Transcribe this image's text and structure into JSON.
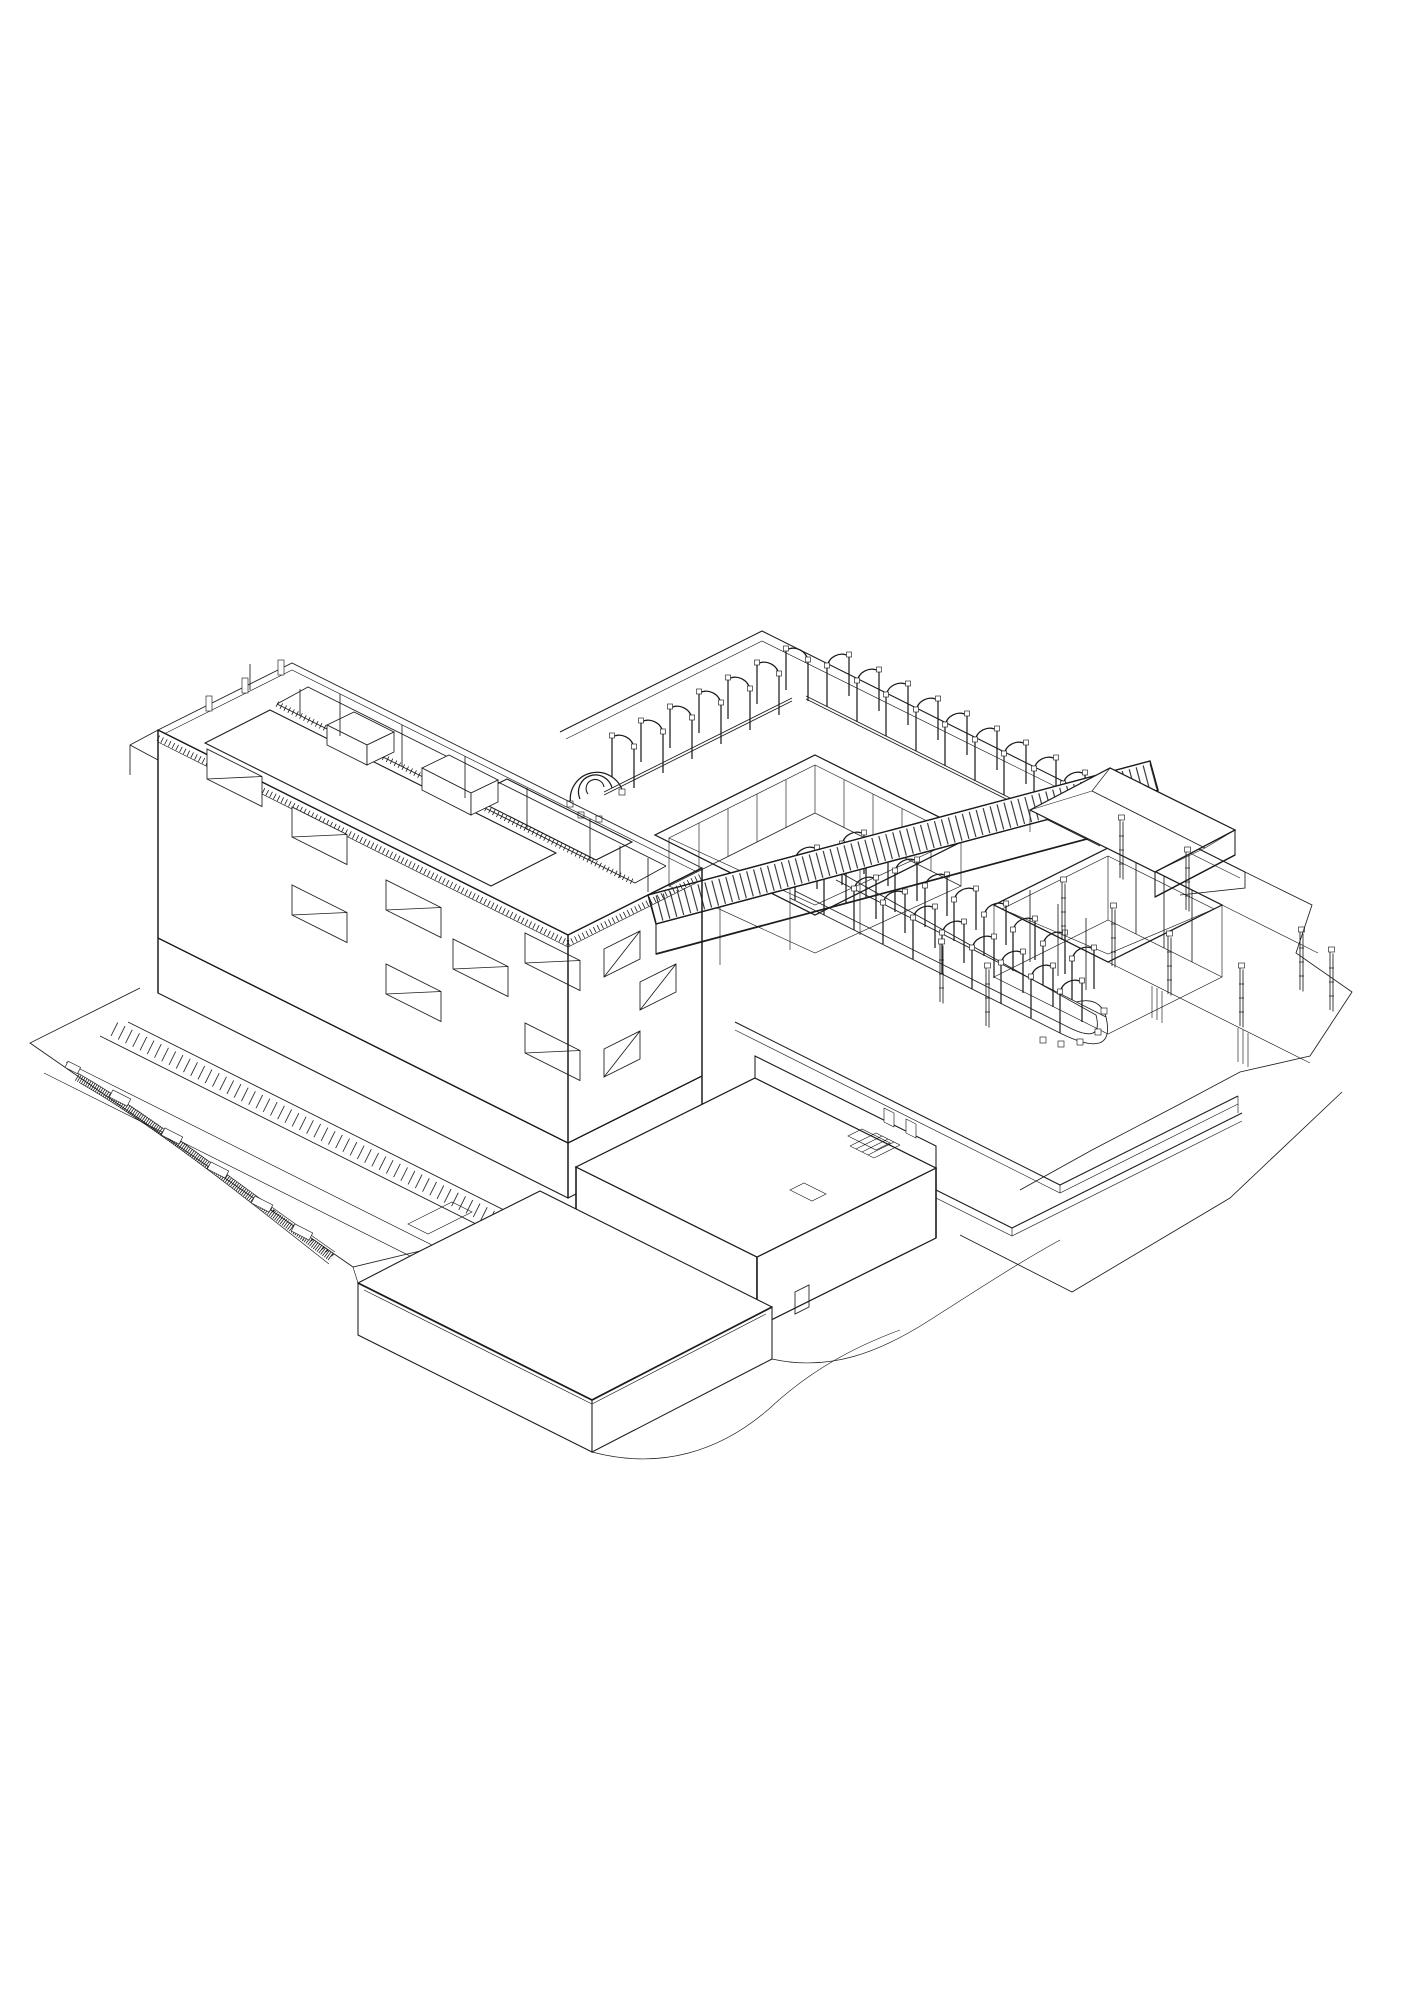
{
  "canvas": {
    "width": 1414,
    "height": 2000,
    "paper_color": "#ffffff",
    "ink_color": "#1c1c1c"
  },
  "scene": {
    "labels": {
      "drawing": "Black and white axonometric architectural line drawing of a building complex",
      "tower": "Multi-storey slab tower with gridded window facade",
      "tower_roof": "Tower roof with sawtooth photovoltaic panel arrays, parapets, bulkhead boxes and slender poles",
      "facade_sw": "South-west facade grid with recessed balconies",
      "facade_se": "South-east facade grid with recessed balconies",
      "podium_plane": "Large flat podium roof plane",
      "courtyard_main": "Central courtyard void with interior columns",
      "courtyard_east": "Eastern sunken courtyard with tall columns",
      "skybridge": "Diagonal rooftop walkway bridge with slatted deck and glazed rail",
      "pergola_upper": "Upper row of arched pergola hoops ending in a spiral curl",
      "pergola_lower": "Lower arched pergola promenade looping in a hairpin",
      "pavilion": "Small roof pavilion with folded plate roof and clerestory glazing",
      "terraces": "Stepped south-east terraces with slender service posts",
      "site_boundary": "Irregular site boundary and terrain contour lines",
      "annex": "Low annex block with roof stair and hatch",
      "plinth": "Entrance plinth slab with sloped ground faces",
      "plaza": "Ground level plaza outline",
      "pavement": "Striped pavement band along the tower base",
      "ramp": "Hatched exterior ramp with step landings"
    },
    "counts": {
      "upper_pergola_hoops": 17,
      "lower_pergola_hoops": 19,
      "terrace_posts": 10,
      "courtyards": 2
    },
    "style": {
      "line_color": "#1c1c1c",
      "background": "#ffffff",
      "projection": "isometric 2:1"
    }
  }
}
